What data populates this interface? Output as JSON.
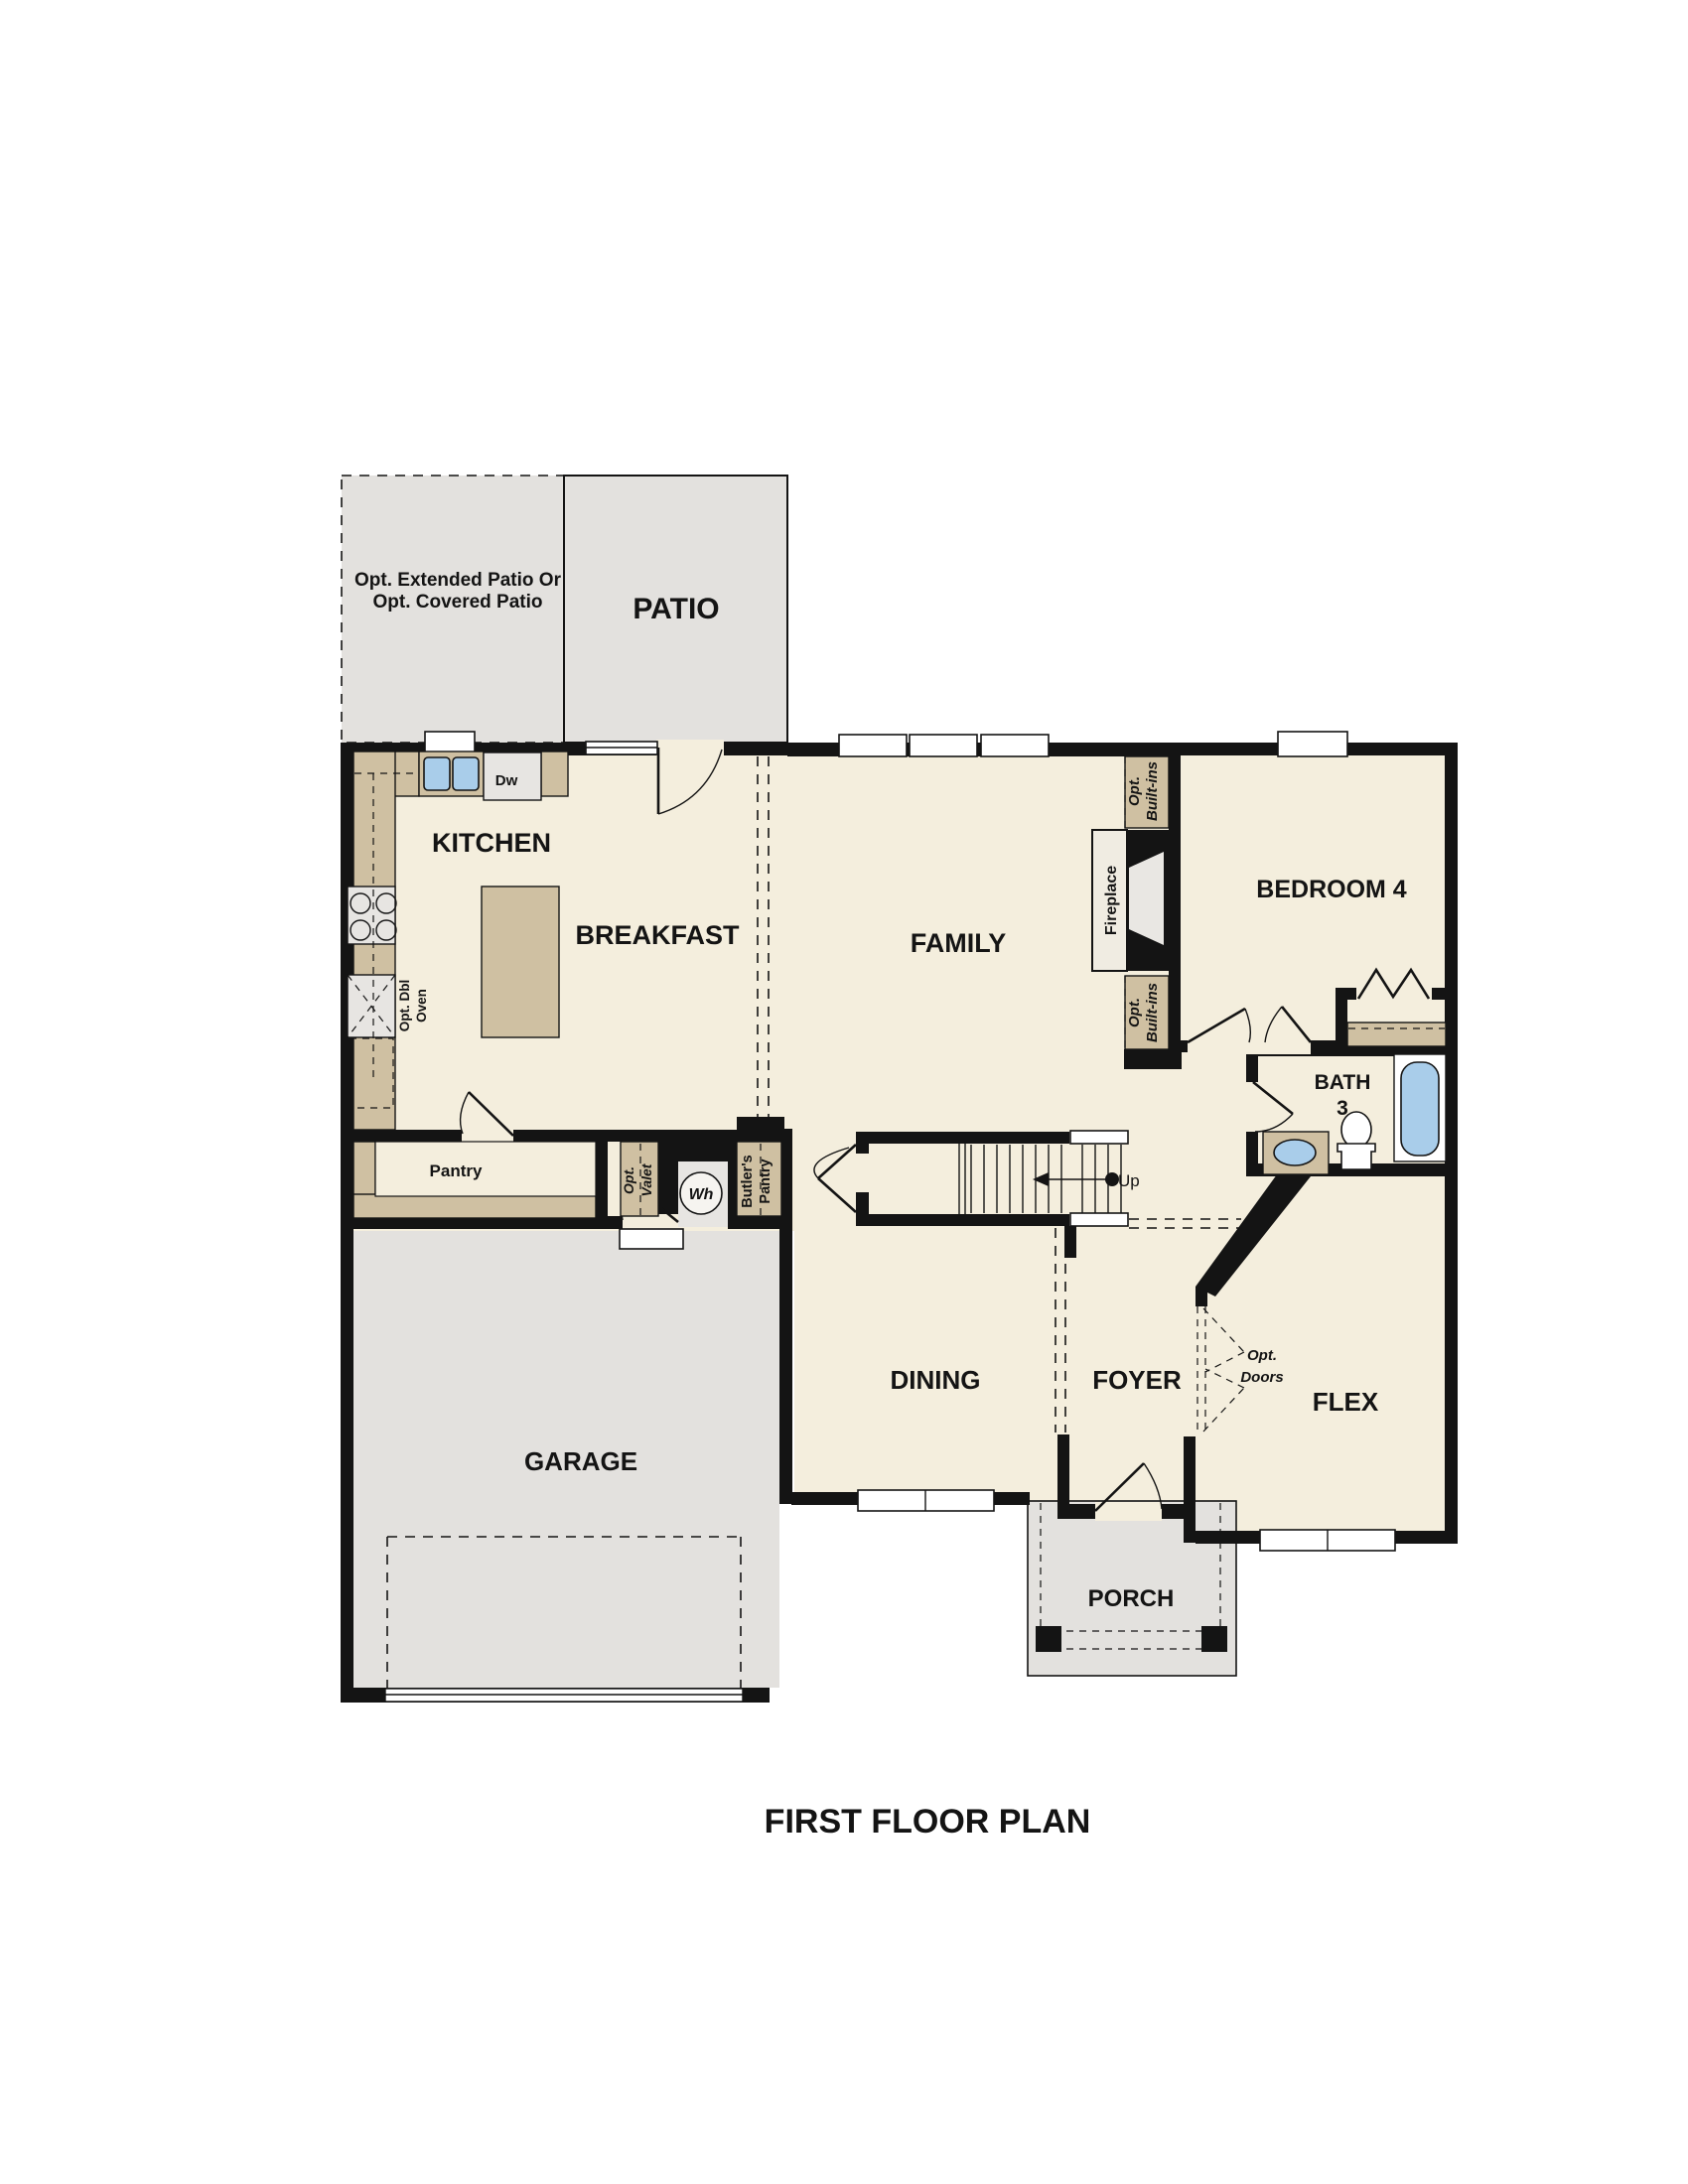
{
  "title": "FIRST FLOOR PLAN",
  "rooms": {
    "patio": "PATIO",
    "opt_patio_line1": "Opt. Extended Patio Or",
    "opt_patio_line2": "Opt. Covered Patio",
    "kitchen": "KITCHEN",
    "breakfast": "BREAKFAST",
    "family": "FAMILY",
    "bedroom4": "BEDROOM 4",
    "bath_line1": "BATH",
    "bath_line2": "3",
    "dining": "DINING",
    "foyer": "FOYER",
    "flex": "FLEX",
    "garage": "GARAGE",
    "porch": "PORCH",
    "pantry": "Pantry"
  },
  "features": {
    "fireplace": "Fireplace",
    "opt_builtins_1": "Opt.",
    "opt_builtins_2": "Built-ins",
    "opt_valet_1": "Opt.",
    "opt_valet_2": "Valet",
    "butlers_1": "Butler's",
    "butlers_2": "Pantry",
    "dbl_oven_1": "Opt. Dbl",
    "dbl_oven_2": "Oven",
    "dishwasher": "Dw",
    "water_heater": "Wh",
    "stairs_up": "Up",
    "opt_doors_1": "Opt.",
    "opt_doors_2": "Doors"
  },
  "colors": {
    "wall": "#141414",
    "floor": "#f4eedd",
    "concrete": "#e3e1de",
    "casework": "#cfc0a2",
    "appliance": "#e7e5e2",
    "water": "#a9cdea",
    "background": "#ffffff"
  }
}
